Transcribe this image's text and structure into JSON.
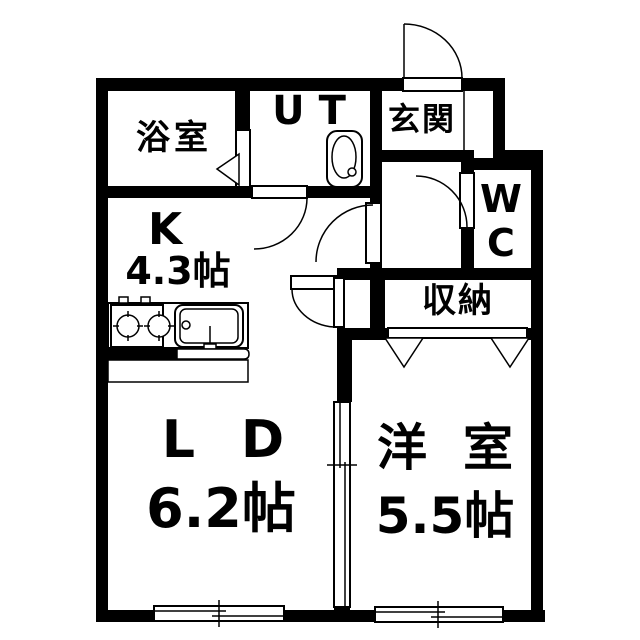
{
  "floorplan": {
    "rooms": {
      "bath": {
        "label": "浴室"
      },
      "utility": {
        "label": "UT"
      },
      "entrance": {
        "label": "玄関"
      },
      "wc": {
        "line1": "W",
        "line2": "C"
      },
      "storage": {
        "label": "収納"
      },
      "kitchen": {
        "label": "K",
        "size": "4.3帖"
      },
      "living": {
        "label": "LD",
        "size": "6.2帖"
      },
      "western": {
        "label": "洋室",
        "size": "5.5帖"
      }
    },
    "colors": {
      "wall": "#000000",
      "background": "#ffffff",
      "line": "#000000"
    }
  }
}
